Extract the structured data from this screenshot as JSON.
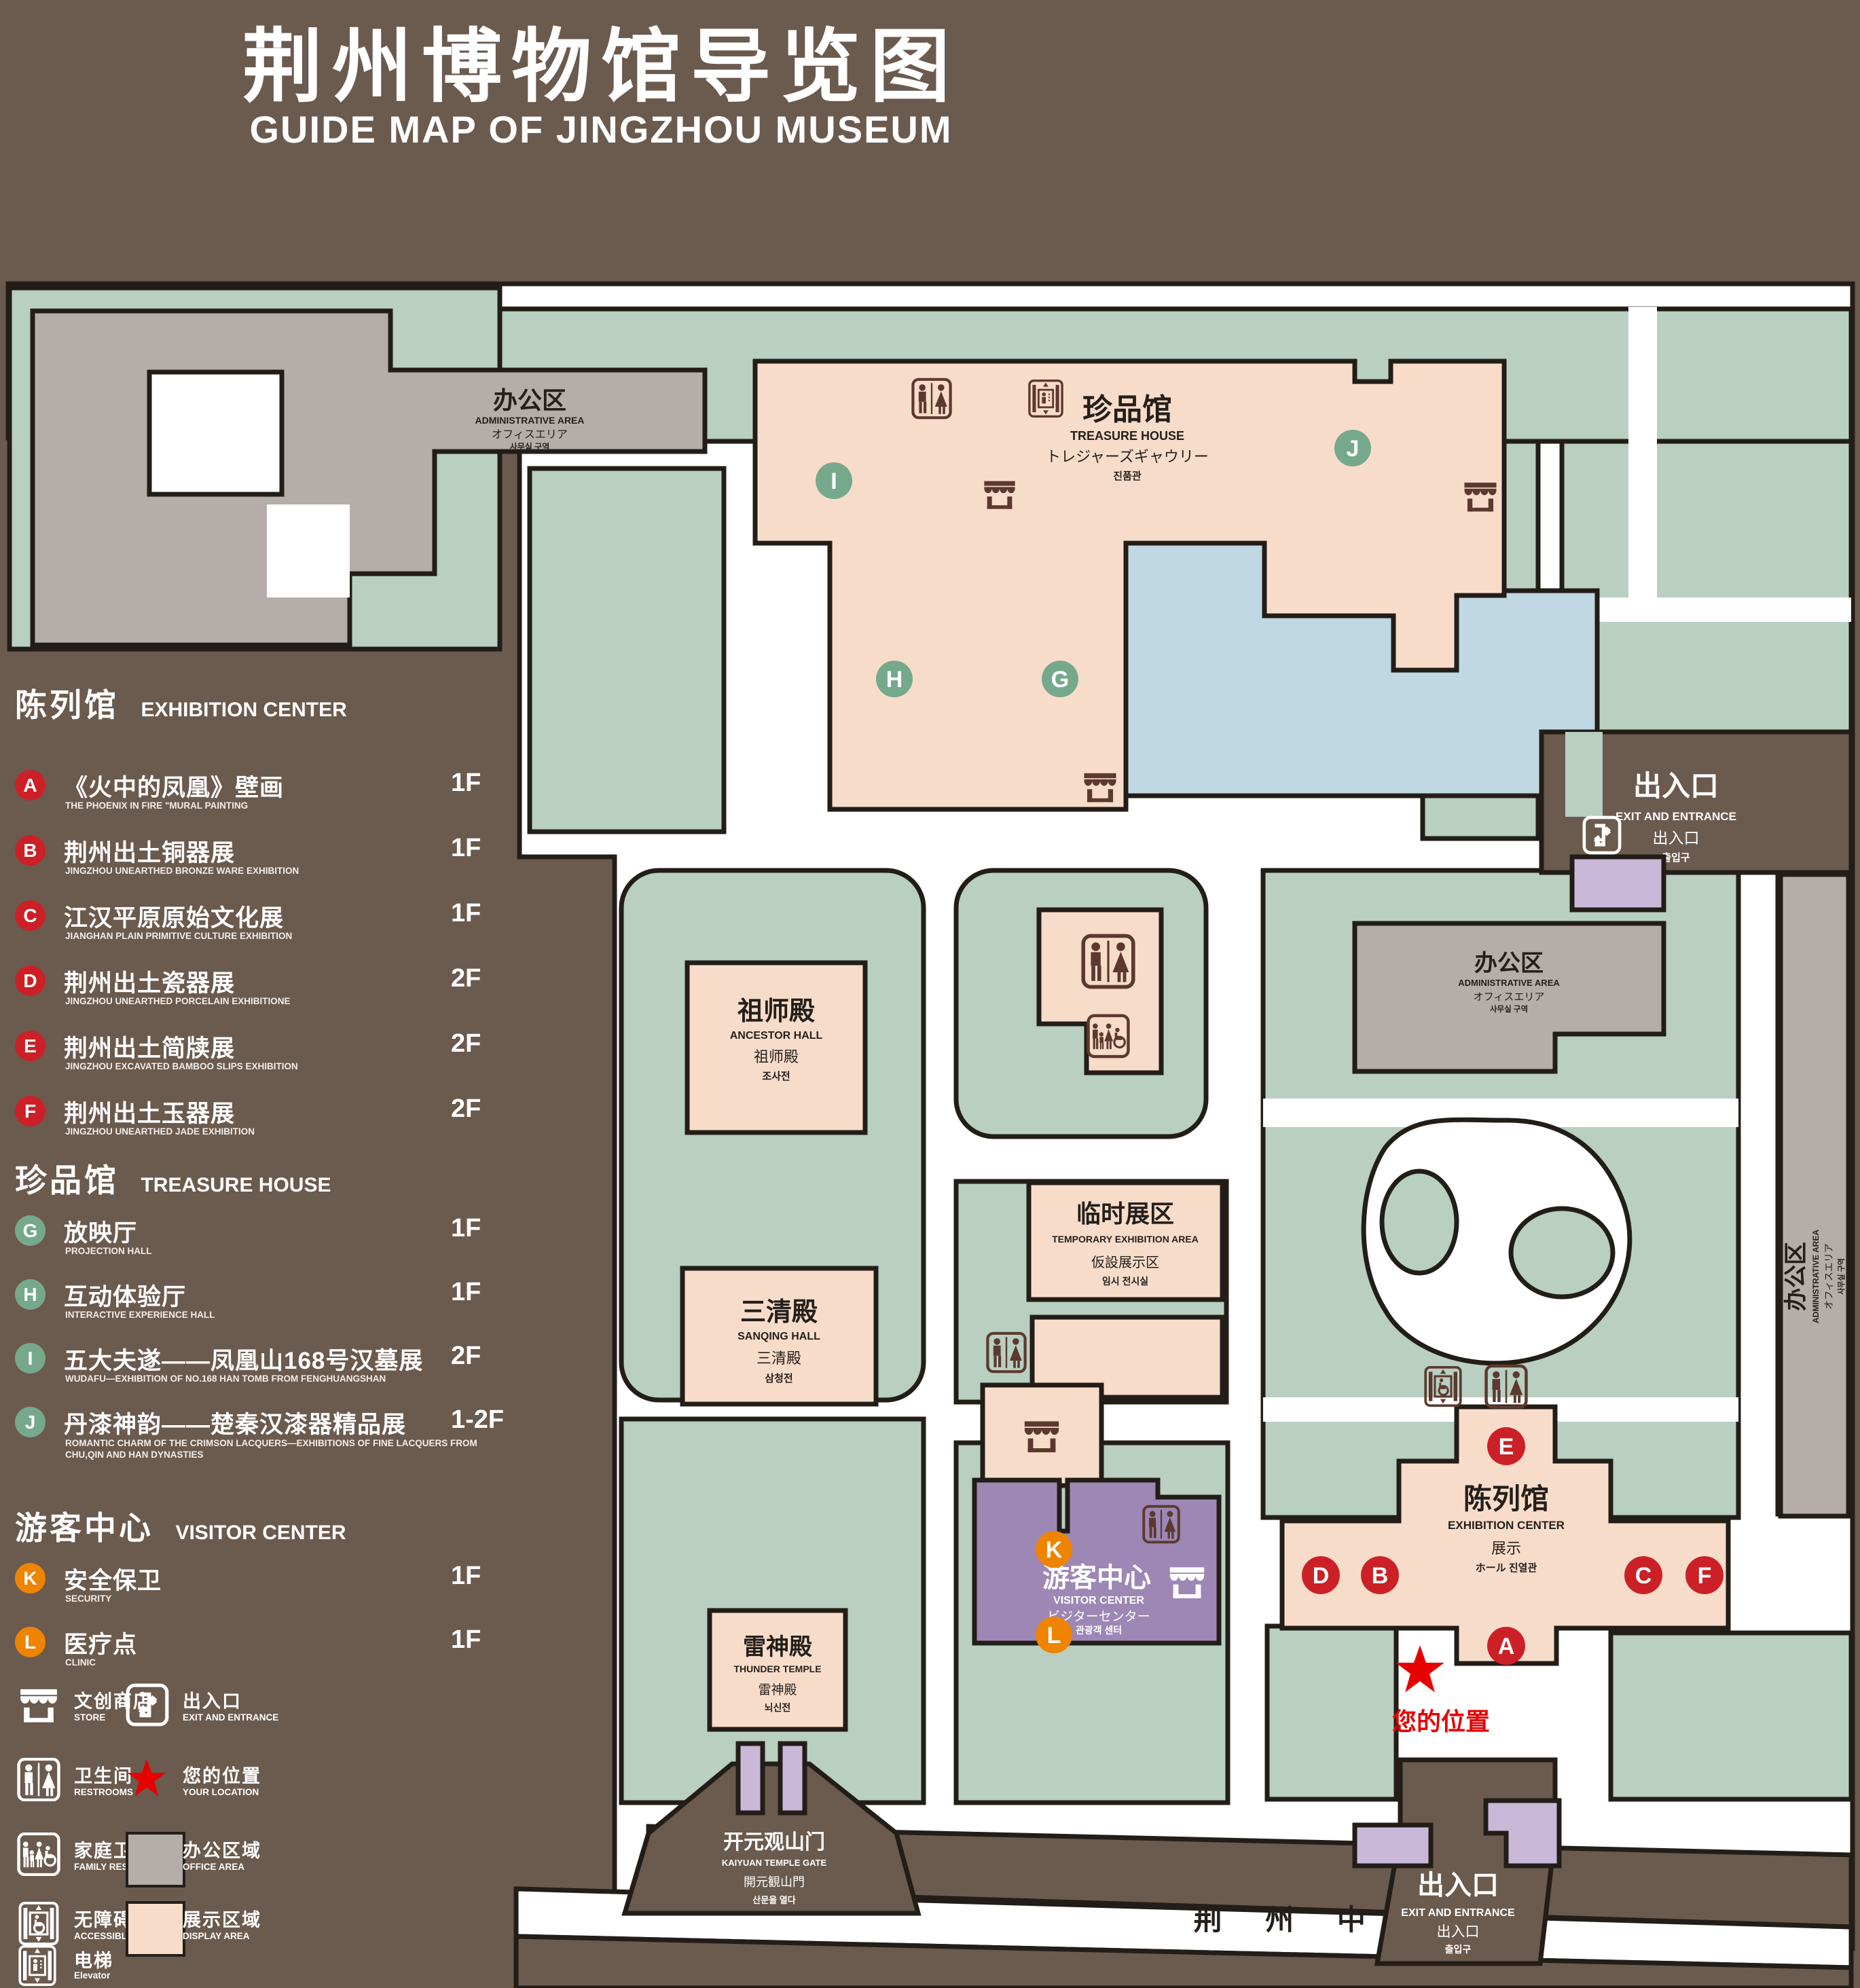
{
  "title": {
    "zh": "荆州博物馆导览图",
    "en": "GUIDE MAP OF JINGZHOU MUSEUM"
  },
  "colors": {
    "background": "#6b5a4e",
    "park_green": "#b8cfc1",
    "display_pink": "#f8dcca",
    "office_gray": "#b4adaa",
    "visitor_purple": "#9d87b5",
    "gate_purple": "#c9b8d8",
    "lake_blue": "#c0d8e3",
    "badge_red": "#cc2027",
    "badge_green": "#76a98c",
    "badge_orange": "#ee8400",
    "location_red": "#e60000",
    "icon_brown": "#5c392e"
  },
  "legend": {
    "sections": [
      {
        "zh": "陈列馆",
        "en": "EXHIBITION CENTER",
        "items": [
          {
            "id": "A",
            "zh": "《火中的凤凰》壁画",
            "en": "THE PHOENIX IN FIRE \"MURAL PAINTING",
            "floor": "1F"
          },
          {
            "id": "B",
            "zh": "荆州出土铜器展",
            "en": "JINGZHOU UNEARTHED BRONZE WARE EXHIBITION",
            "floor": "1F"
          },
          {
            "id": "C",
            "zh": "江汉平原原始文化展",
            "en": "JIANGHAN PLAIN PRIMITIVE CULTURE EXHIBITION",
            "floor": "1F"
          },
          {
            "id": "D",
            "zh": "荆州出土瓷器展",
            "en": "JINGZHOU UNEARTHED PORCELAIN EXHIBITIONE",
            "floor": "2F"
          },
          {
            "id": "E",
            "zh": "荆州出土简牍展",
            "en": "JINGZHOU EXCAVATED BAMBOO SLIPS EXHIBITION",
            "floor": "2F"
          },
          {
            "id": "F",
            "zh": "荆州出土玉器展",
            "en": "JINGZHOU UNEARTHED JADE EXHIBITION",
            "floor": "2F"
          }
        ]
      },
      {
        "zh": "珍品馆",
        "en": "TREASURE HOUSE",
        "items": [
          {
            "id": "G",
            "zh": "放映厅",
            "en": "PROJECTION HALL",
            "floor": "1F"
          },
          {
            "id": "H",
            "zh": "互动体验厅",
            "en": "INTERACTIVE EXPERIENCE HALL",
            "floor": "1F"
          },
          {
            "id": "I",
            "zh": "五大夫遂——凤凰山168号汉墓展",
            "en": "WUDAFU—EXHIBITION OF NO.168 HAN TOMB FROM FENGHUANGSHAN",
            "floor": "2F"
          },
          {
            "id": "J",
            "zh": "丹漆神韵——楚秦汉漆器精品展",
            "en": "ROMANTIC CHARM OF THE CRIMSON LACQUERS—EXHIBITIONS OF FINE LACQUERS FROM CHU,QIN AND HAN DYNASTIES",
            "floor": "1-2F"
          }
        ]
      },
      {
        "zh": "游客中心",
        "en": "VISITOR CENTER",
        "items": [
          {
            "id": "K",
            "zh": "安全保卫",
            "en": "SECURITY",
            "floor": "1F"
          },
          {
            "id": "L",
            "zh": "医疗点",
            "en": "CLINIC",
            "floor": "1F"
          }
        ]
      }
    ],
    "symbols": [
      {
        "icon": "store",
        "zh": "文创商店",
        "en": "STORE"
      },
      {
        "icon": "exit",
        "zh": "出入口",
        "en": "EXIT AND ENTRANCE"
      },
      {
        "icon": "restroom",
        "zh": "卫生间",
        "en": "RESTROOMS"
      },
      {
        "icon": "location",
        "zh": "您的位置",
        "en": "YOUR LOCATION"
      },
      {
        "icon": "family-restroom",
        "zh": "家庭卫生间",
        "en": "FAMILY RESTROOMS"
      },
      {
        "icon": "office-swatch",
        "zh": "办公区域",
        "en": "OFFICE AREA"
      },
      {
        "icon": "accessible-elevator",
        "zh": "无障碍电梯",
        "en": "ACCESSIBLE ELEVATOR"
      },
      {
        "icon": "display-swatch",
        "zh": "展示区域",
        "en": "DISPLAY AREA"
      },
      {
        "icon": "elevator",
        "zh": "电梯",
        "en": "Elevator"
      }
    ]
  },
  "map": {
    "marker_letters": [
      "A",
      "B",
      "C",
      "D",
      "E",
      "F",
      "G",
      "H",
      "I",
      "J",
      "K",
      "L"
    ],
    "buildings": {
      "admin": {
        "lines": [
          "办公区",
          "ADMINISTRATIVE AREA",
          "オフィスエリア",
          "사무실 구역"
        ]
      },
      "treasure_house": {
        "lines": [
          "珍品馆",
          "TREASURE HOUSE",
          "トレジャーズギャウリー",
          "진품관"
        ]
      },
      "ancestor_hall": {
        "lines": [
          "祖师殿",
          "ANCESTOR HALL",
          "祖师殿",
          "조사전"
        ]
      },
      "temporary_exhibition": {
        "lines": [
          "临时展区",
          "TEMPORARY EXHIBITION AREA",
          "仮設展示区",
          "임시 전시실"
        ]
      },
      "sanqing_hall": {
        "lines": [
          "三清殿",
          "SANQING HALL",
          "三清殿",
          "삼청전"
        ]
      },
      "thunder_temple": {
        "lines": [
          "雷神殿",
          "THUNDER TEMPLE",
          "雷神殿",
          "뇌신전"
        ]
      },
      "exhibition_center": {
        "lines": [
          "陈列馆",
          "EXHIBITION CENTER",
          "展示",
          "ホール 진열관"
        ]
      },
      "visitor_center": {
        "lines": [
          "游客中心",
          "VISITOR CENTER",
          "ビジターセンター",
          "관광객 센터"
        ]
      },
      "kaiyuan_gate": {
        "lines": [
          "开元观山门",
          "KAIYUAN TEMPLE GATE",
          "開元観山門",
          "산문을 열다"
        ]
      }
    },
    "exit_labels": {
      "lines": [
        "出入口",
        "EXIT AND ENTRANCE",
        "出入口",
        "출입구"
      ]
    },
    "road": "荆 州 中 路",
    "your_location": "您的位置"
  }
}
